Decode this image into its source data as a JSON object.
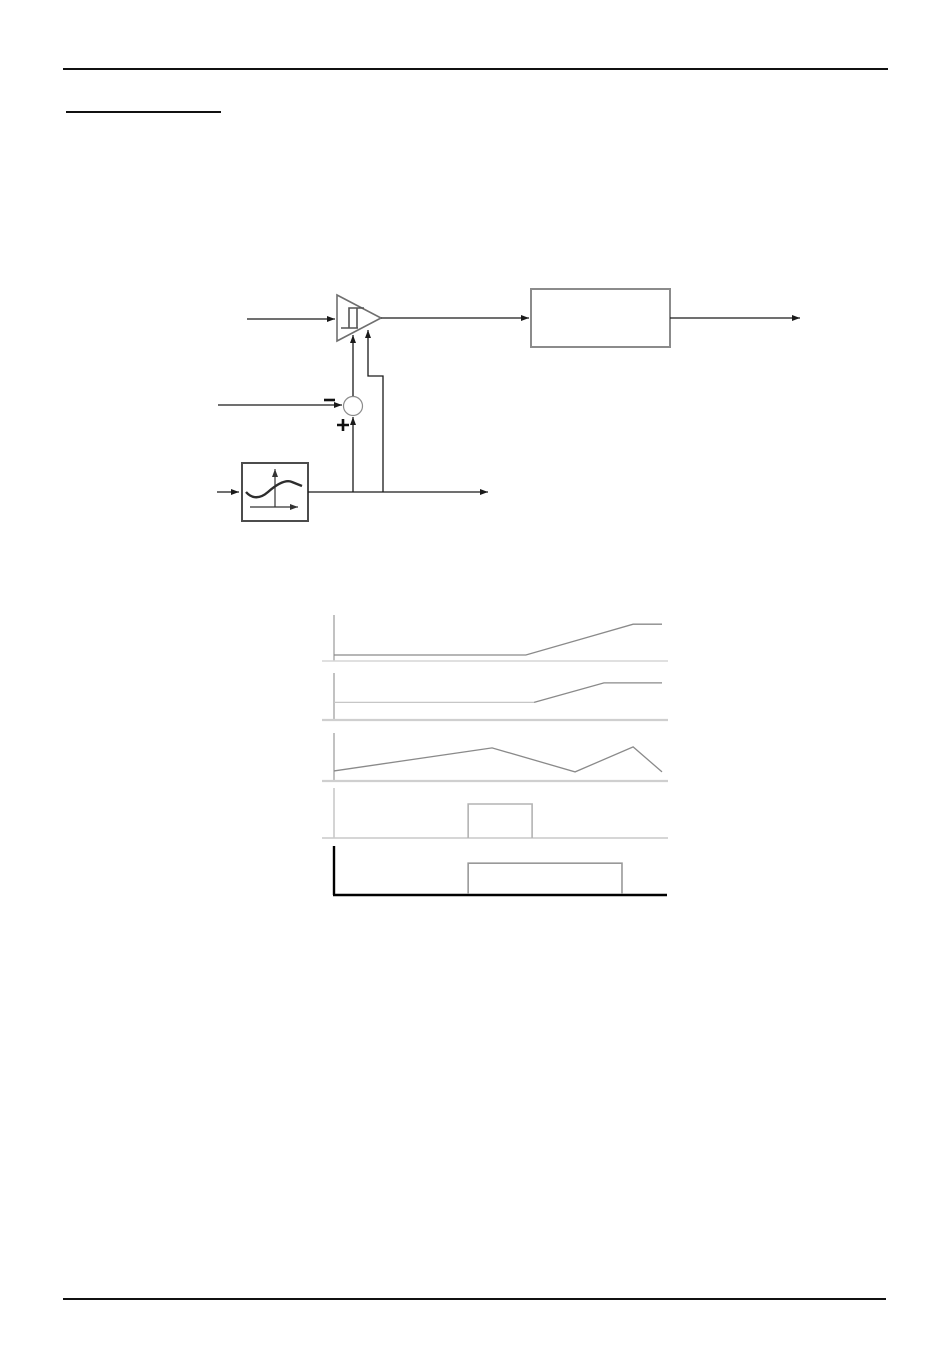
{
  "page": {
    "width": 950,
    "height": 1370,
    "background": "#ffffff",
    "rules": {
      "top": {
        "x1": 63,
        "x2": 888,
        "y": 69,
        "thickness": 2,
        "color": "#111111"
      },
      "heading_underline": {
        "x1": 66,
        "x2": 221,
        "y": 112,
        "thickness": 2,
        "color": "#111111"
      },
      "bottom": {
        "x1": 63,
        "x2": 886,
        "y": 1299,
        "thickness": 2,
        "color": "#111111"
      }
    }
  },
  "block_diagram": {
    "description": "Hysteresis comparator with summing junction and waveform-shaper feedback driving an output block",
    "elements": [
      {
        "name": "comparator-input-line",
        "type": "arrow-line",
        "points": [
          [
            247,
            319
          ],
          [
            335,
            319
          ]
        ],
        "stroke": "#1a1a1a",
        "width": 1.3
      },
      {
        "name": "comparator-triangle",
        "type": "polygon",
        "points": [
          [
            337,
            295
          ],
          [
            337,
            341
          ],
          [
            381,
            318
          ]
        ],
        "stroke": "#6f6f6f",
        "width": 1.6,
        "fill": "none"
      },
      {
        "name": "hysteresis-icon",
        "type": "path",
        "d": "M341,328 H358 M349,328 V308 H364 M357,328 V308",
        "stroke": "#555555",
        "width": 1.6,
        "fill": "none"
      },
      {
        "name": "comparator-output-line",
        "type": "arrow-line",
        "points": [
          [
            381,
            318
          ],
          [
            529,
            318
          ]
        ],
        "stroke": "#1a1a1a",
        "width": 1.3
      },
      {
        "name": "output-block",
        "type": "rect",
        "x": 531,
        "y": 289,
        "w": 139,
        "h": 58,
        "stroke": "#8b8b8b",
        "width": 2,
        "fill": "#ffffff"
      },
      {
        "name": "final-output-line",
        "type": "arrow-line",
        "points": [
          [
            670,
            318
          ],
          [
            800,
            318
          ]
        ],
        "stroke": "#1a1a1a",
        "width": 1.3
      },
      {
        "name": "summing-input-line",
        "type": "arrow-line",
        "points": [
          [
            218,
            405
          ],
          [
            342,
            405
          ]
        ],
        "stroke": "#1a1a1a",
        "width": 1.3
      },
      {
        "name": "minus-sign",
        "type": "path",
        "d": "M324,400 H335",
        "stroke": "#111111",
        "width": 2.6,
        "fill": "none"
      },
      {
        "name": "summing-junction",
        "type": "circle",
        "cx": 353,
        "cy": 406,
        "r": 9.5,
        "stroke": "#8b8b8b",
        "width": 1.2,
        "fill": "#ffffff"
      },
      {
        "name": "plus-sign",
        "type": "path",
        "d": "M337,425 H349 M343,419 V431",
        "stroke": "#111111",
        "width": 2.6,
        "fill": "none"
      },
      {
        "name": "sum-to-comparator-line",
        "type": "arrow-line",
        "points": [
          [
            353,
            396
          ],
          [
            353,
            335
          ]
        ],
        "stroke": "#1a1a1a",
        "width": 1.3
      },
      {
        "name": "feedback-to-sum-line",
        "type": "arrow-line",
        "points": [
          [
            353,
            492
          ],
          [
            353,
            417
          ]
        ],
        "stroke": "#1a1a1a",
        "width": 1.3
      },
      {
        "name": "feedback-to-comparator-line",
        "type": "arrow-line",
        "points": [
          [
            383,
            492
          ],
          [
            383,
            376
          ],
          [
            368,
            376
          ],
          [
            368,
            330
          ]
        ],
        "stroke": "#1a1a1a",
        "width": 1.3
      },
      {
        "name": "shaper-block",
        "type": "rect",
        "x": 242,
        "y": 463,
        "w": 66,
        "h": 58,
        "stroke": "#4c4c4c",
        "width": 2,
        "fill": "#ffffff"
      },
      {
        "name": "shaper-y-axis",
        "type": "arrow-line",
        "points": [
          [
            275,
            507
          ],
          [
            275,
            469
          ]
        ],
        "stroke": "#333333",
        "width": 1.2
      },
      {
        "name": "shaper-x-axis",
        "type": "arrow-line",
        "points": [
          [
            250,
            507
          ],
          [
            298,
            507
          ]
        ],
        "stroke": "#333333",
        "width": 1.2
      },
      {
        "name": "shaper-curve",
        "type": "path",
        "d": "M246,492 C252,499 260,499 268,492 C276,485 285,479 292,482 L302,486",
        "stroke": "#2d2d2d",
        "width": 2.4,
        "fill": "none"
      },
      {
        "name": "shaper-input-line",
        "type": "arrow-line",
        "points": [
          [
            217,
            492
          ],
          [
            239,
            492
          ]
        ],
        "stroke": "#1a1a1a",
        "width": 1.3
      },
      {
        "name": "shaper-output-line",
        "type": "arrow-line",
        "points": [
          [
            308,
            492
          ],
          [
            488,
            492
          ]
        ],
        "stroke": "#1a1a1a",
        "width": 1.3
      }
    ]
  },
  "chart_data": [
    {
      "type": "line",
      "title": "",
      "xlabel": "",
      "ylabel": "",
      "grid": false,
      "legend": "none",
      "frame": {
        "axis_x": 334,
        "x_end": 662,
        "top_y": 615,
        "baseline_y": 661,
        "baseline_x1": 322,
        "baseline_x2": 668
      },
      "axis_color": "#9a9a9a",
      "axis_width": 1.2,
      "baseline_color": "#d6d6d6",
      "baseline_width": 1.5,
      "series": [
        {
          "name": "trace",
          "color": "#8a8a8a",
          "width": 1.3,
          "points": [
            [
              0,
              0.13
            ],
            [
              0.585,
              0.13
            ],
            [
              0.912,
              0.8
            ],
            [
              1.0,
              0.8
            ]
          ]
        }
      ]
    },
    {
      "type": "line",
      "title": "",
      "xlabel": "",
      "ylabel": "",
      "grid": false,
      "legend": "none",
      "frame": {
        "axis_x": 334,
        "x_end": 662,
        "top_y": 673,
        "baseline_y": 720,
        "baseline_x1": 322,
        "baseline_x2": 668
      },
      "axis_color": "#9a9a9a",
      "axis_width": 1.2,
      "baseline_color": "#cfcfcf",
      "baseline_width": 2.2,
      "series": [
        {
          "name": "trace-flat-light",
          "color": "#c6c6c6",
          "width": 1.2,
          "points": [
            [
              0,
              0.375
            ],
            [
              0.61,
              0.375
            ]
          ]
        },
        {
          "name": "trace-ramp",
          "color": "#8a8a8a",
          "width": 1.3,
          "points": [
            [
              0.61,
              0.375
            ],
            [
              0.823,
              0.79
            ],
            [
              1.0,
              0.79
            ]
          ]
        }
      ]
    },
    {
      "type": "line",
      "title": "",
      "xlabel": "",
      "ylabel": "",
      "grid": false,
      "legend": "none",
      "frame": {
        "axis_x": 334,
        "x_end": 662,
        "top_y": 733,
        "baseline_y": 781,
        "baseline_x1": 322,
        "baseline_x2": 668
      },
      "axis_color": "#9a9a9a",
      "axis_width": 1.2,
      "baseline_color": "#cfcfcf",
      "baseline_width": 2.2,
      "series": [
        {
          "name": "trace",
          "color": "#8a8a8a",
          "width": 1.3,
          "points": [
            [
              0,
              0.21
            ],
            [
              0.482,
              0.69
            ],
            [
              0.735,
              0.19
            ],
            [
              0.912,
              0.71
            ],
            [
              1.0,
              0.19
            ]
          ]
        }
      ]
    },
    {
      "type": "line",
      "title": "",
      "xlabel": "",
      "ylabel": "",
      "grid": false,
      "legend": "none",
      "frame": {
        "axis_x": 334,
        "x_end": 662,
        "top_y": 788,
        "baseline_y": 838,
        "baseline_x1": 322,
        "baseline_x2": 668
      },
      "axis_color": "#b8b8b8",
      "axis_width": 1.2,
      "baseline_color": "#c9c9c9",
      "baseline_width": 1.4,
      "series": [
        {
          "name": "pulse",
          "color": "#b3b3b3",
          "width": 1.6,
          "points": [
            [
              0.409,
              0.0
            ],
            [
              0.409,
              0.68
            ],
            [
              0.604,
              0.68
            ],
            [
              0.604,
              0.0
            ]
          ]
        }
      ]
    },
    {
      "type": "line",
      "title": "",
      "xlabel": "",
      "ylabel": "",
      "grid": false,
      "legend": "none",
      "frame": {
        "axis_x": 334,
        "x_end": 662,
        "top_y": 846,
        "baseline_y": 895,
        "baseline_x1": 333,
        "baseline_x2": 667
      },
      "axis_color": "#000000",
      "axis_width": 2.4,
      "baseline_color": "#000000",
      "baseline_width": 2.6,
      "series": [
        {
          "name": "pulse",
          "color": "#999999",
          "width": 1.6,
          "points": [
            [
              0.409,
              0.02
            ],
            [
              0.409,
              0.65
            ],
            [
              0.878,
              0.65
            ],
            [
              0.878,
              0.02
            ]
          ]
        }
      ]
    }
  ]
}
